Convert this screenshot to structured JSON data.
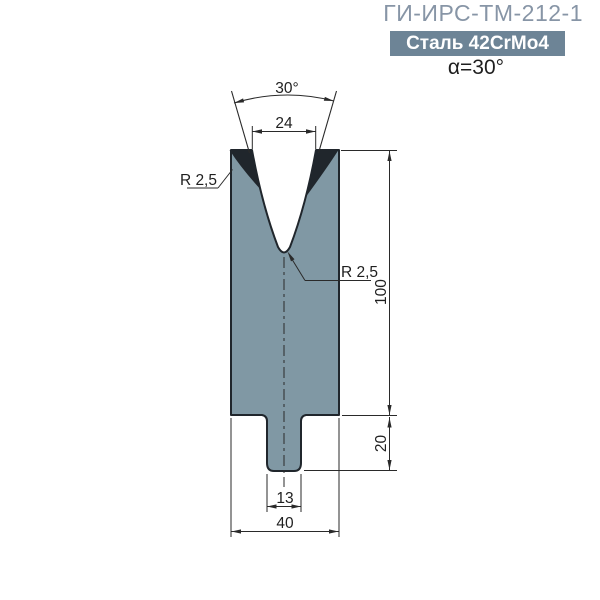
{
  "header": {
    "title": "ГИ-ИРС-ТМ-212-1",
    "material": "Сталь 42CrMo4",
    "angle_note": "α=30°"
  },
  "drawing": {
    "labels": {
      "angle": "30°",
      "opening_width": "24",
      "body_height": "100",
      "tang_height": "20",
      "tang_width": "13",
      "body_width": "40",
      "shoulder_radius": "R 2,5",
      "tip_radius": "R 2,5"
    },
    "colors": {
      "die_fill": "#8098a4",
      "outline": "#20262c",
      "dim": "#2a2a2a",
      "title": "#8795a6",
      "badge_bg": "#6d8496",
      "badge_text": "#ffffff",
      "note": "#1f1f1f"
    }
  }
}
